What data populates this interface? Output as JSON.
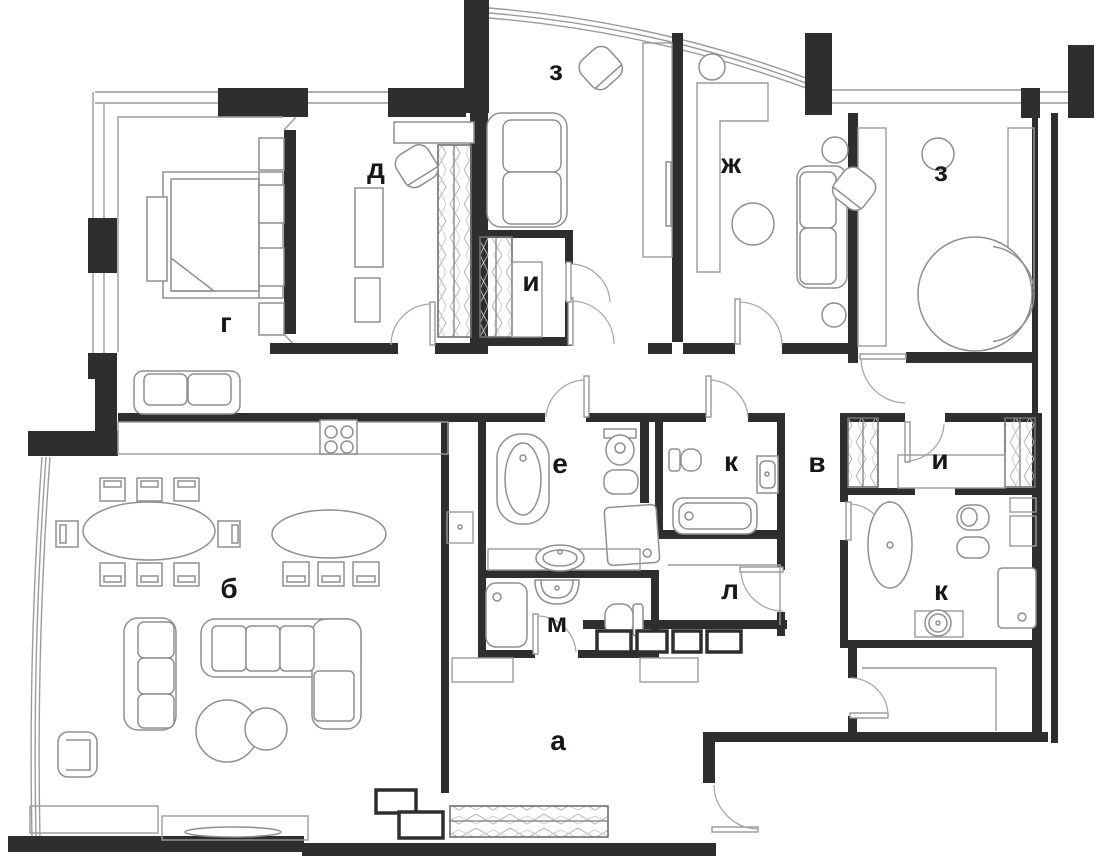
{
  "plan": {
    "type": "apartment-floor-plan",
    "canvas": {
      "width": 1098,
      "height": 858,
      "background": "#ffffff"
    },
    "colors": {
      "wall": "#2e2e2e",
      "outline": "#9b9b9b",
      "furniture": "#8f8f8f",
      "hatch": "#b5b5b5",
      "label": "#16171d"
    },
    "rooms": [
      {
        "id": "bedroom-z-left",
        "label": "з"
      },
      {
        "id": "study-d",
        "label": "д"
      },
      {
        "id": "room-zh",
        "label": "ж"
      },
      {
        "id": "bedroom-z-right",
        "label": "з"
      },
      {
        "id": "bedroom-g",
        "label": "г"
      },
      {
        "id": "closet-i-top",
        "label": "и"
      },
      {
        "id": "bathroom-e",
        "label": "е"
      },
      {
        "id": "bathroom-k-top",
        "label": "к"
      },
      {
        "id": "corridor-v",
        "label": "в"
      },
      {
        "id": "closet-i-right",
        "label": "и"
      },
      {
        "id": "living-room-b",
        "label": "б"
      },
      {
        "id": "storage-l",
        "label": "л"
      },
      {
        "id": "bathroom-k-right",
        "label": "к"
      },
      {
        "id": "bathroom-m",
        "label": "м"
      },
      {
        "id": "hall-a",
        "label": "а"
      }
    ]
  }
}
